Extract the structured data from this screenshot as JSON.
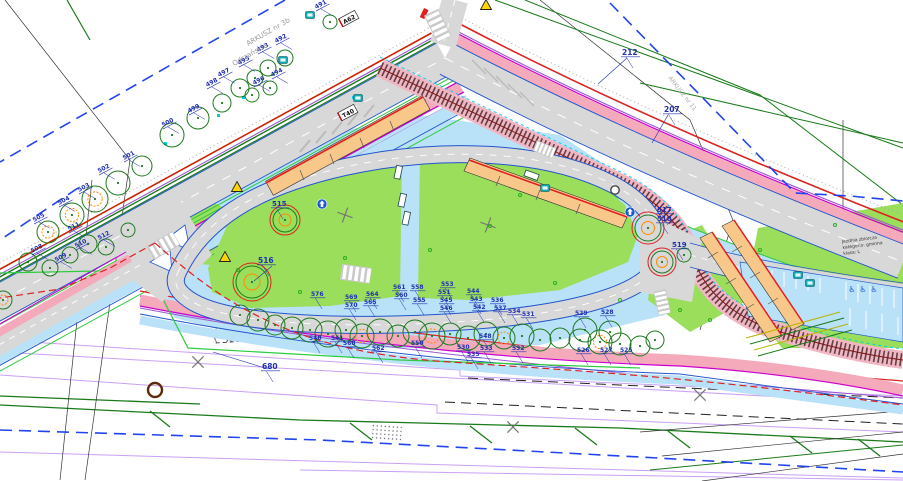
{
  "plan": {
    "title": "tram-bus loop site plan (CAD sheet fragment)",
    "palette": {
      "grass": "#9ade5b",
      "pavement": "#b9e2f8",
      "road": "#d8d8d8",
      "cycle_pink": "#f4aabb",
      "magenta": "#cc00cc",
      "purple": "#9b59d0",
      "lot_purple": "#c9a0f5",
      "red": "#dd2222",
      "dark_green": "#1a7a1a",
      "bright_green": "#2ecc40",
      "blue": "#2255cc",
      "boundary_blue": "#2244ee",
      "cyan": "#00ccee",
      "platform": "#f8c88a",
      "platform_edge": "#e02020",
      "tram_pink": "#f0b6c4",
      "label_blue": "#2030b0",
      "gray_text": "#999999",
      "tree_green": "#1f7a1f",
      "tree_orange": "#ff8c00",
      "tree_red": "#dd2222",
      "sign_yellow": "#ffd400",
      "sign_teal": "#12aab4",
      "sign_blue": "#1a56d6"
    },
    "texts_static": {
      "arkusz": "ARKUSZ nr 3b",
      "odrzanskie": "Odrzańskie",
      "arkusz11": "ARKUSZ nr 11",
      "note1": "Jezdnia zbiorcza",
      "note2": "kategoria: gminna",
      "note3": "klasa: L"
    },
    "plates": [
      {
        "t": "A62",
        "x": 349,
        "y": 19,
        "rot": -28
      },
      {
        "t": "T40",
        "x": 348,
        "y": 113,
        "rot": -28
      }
    ],
    "labels": [
      {
        "t": "491",
        "x": 316,
        "y": 9,
        "rot": -28
      },
      {
        "t": "492",
        "x": 276,
        "y": 43,
        "rot": -28
      },
      {
        "t": "493",
        "x": 258,
        "y": 52,
        "rot": -28
      },
      {
        "t": "494",
        "x": 272,
        "y": 77,
        "rot": -28
      },
      {
        "t": "495",
        "x": 239,
        "y": 65,
        "rot": -28
      },
      {
        "t": "496",
        "x": 254,
        "y": 85,
        "rot": -28
      },
      {
        "t": "497",
        "x": 219,
        "y": 77,
        "rot": -28
      },
      {
        "t": "498",
        "x": 207,
        "y": 87,
        "rot": -28
      },
      {
        "t": "499",
        "x": 189,
        "y": 113,
        "rot": -28
      },
      {
        "t": "500",
        "x": 163,
        "y": 127,
        "rot": -28
      },
      {
        "t": "501",
        "x": 124,
        "y": 160,
        "rot": -28
      },
      {
        "t": "502",
        "x": 99,
        "y": 173,
        "rot": -28
      },
      {
        "t": "503",
        "x": 79,
        "y": 192,
        "rot": -28
      },
      {
        "t": "504",
        "x": 59,
        "y": 205,
        "rot": -28
      },
      {
        "t": "505",
        "x": 34,
        "y": 222,
        "rot": -28
      },
      {
        "t": "508",
        "x": 32,
        "y": 253,
        "rot": -28
      },
      {
        "t": "509",
        "x": 56,
        "y": 262,
        "rot": -28
      },
      {
        "t": "510",
        "x": 76,
        "y": 248,
        "rot": -28
      },
      {
        "t": "511",
        "x": 69,
        "y": 231,
        "rot": -28
      },
      {
        "t": "512",
        "x": 99,
        "y": 240,
        "rot": -28
      },
      {
        "t": "515",
        "x": 272,
        "y": 206,
        "rot": 0,
        "s": 7
      },
      {
        "t": "516",
        "x": 258,
        "y": 263,
        "rot": 0,
        "s": 7.5
      },
      {
        "t": "517",
        "x": 657,
        "y": 212,
        "rot": 0,
        "s": 7
      },
      {
        "t": "518",
        "x": 657,
        "y": 221,
        "rot": 0,
        "s": 7
      },
      {
        "t": "519",
        "x": 672,
        "y": 247,
        "rot": 0,
        "s": 7
      },
      {
        "t": "212",
        "x": 622,
        "y": 55,
        "rot": 0,
        "s": 7.5
      },
      {
        "t": "207",
        "x": 664,
        "y": 112,
        "rot": 0,
        "s": 7.5
      },
      {
        "t": "680",
        "x": 262,
        "y": 369,
        "rot": 0,
        "s": 7.5
      },
      {
        "t": "576",
        "x": 311,
        "y": 296,
        "rot": 0
      },
      {
        "t": "569",
        "x": 345,
        "y": 299,
        "rot": 0
      },
      {
        "t": "570",
        "x": 345,
        "y": 307,
        "rot": 0
      },
      {
        "t": "568",
        "x": 343,
        "y": 345,
        "rot": 0
      },
      {
        "t": "564",
        "x": 366,
        "y": 296,
        "rot": 0
      },
      {
        "t": "565",
        "x": 364,
        "y": 304,
        "rot": 0
      },
      {
        "t": "561",
        "x": 393,
        "y": 289,
        "rot": 0
      },
      {
        "t": "560",
        "x": 395,
        "y": 297,
        "rot": 0
      },
      {
        "t": "558",
        "x": 411,
        "y": 289,
        "rot": 0
      },
      {
        "t": "555",
        "x": 413,
        "y": 302,
        "rot": 0
      },
      {
        "t": "553",
        "x": 441,
        "y": 286,
        "rot": 0
      },
      {
        "t": "551",
        "x": 438,
        "y": 294,
        "rot": 0
      },
      {
        "t": "545",
        "x": 440,
        "y": 302,
        "rot": 0
      },
      {
        "t": "546",
        "x": 440,
        "y": 310,
        "rot": 0
      },
      {
        "t": "544",
        "x": 467,
        "y": 293,
        "rot": 0
      },
      {
        "t": "543",
        "x": 470,
        "y": 301,
        "rot": 0
      },
      {
        "t": "542",
        "x": 473,
        "y": 309,
        "rot": 0
      },
      {
        "t": "536",
        "x": 491,
        "y": 302,
        "rot": 0
      },
      {
        "t": "537",
        "x": 494,
        "y": 310,
        "rot": 0
      },
      {
        "t": "534",
        "x": 508,
        "y": 313,
        "rot": 0
      },
      {
        "t": "531",
        "x": 522,
        "y": 316,
        "rot": 0
      },
      {
        "t": "562",
        "x": 372,
        "y": 350,
        "rot": 0
      },
      {
        "t": "550",
        "x": 411,
        "y": 345,
        "rot": 0
      },
      {
        "t": "548",
        "x": 479,
        "y": 338,
        "rot": 0
      },
      {
        "t": "541",
        "x": 331,
        "y": 340,
        "rot": 0
      },
      {
        "t": "540",
        "x": 309,
        "y": 340,
        "rot": 0
      },
      {
        "t": "530",
        "x": 457,
        "y": 349,
        "rot": 0
      },
      {
        "t": "535",
        "x": 467,
        "y": 356,
        "rot": 0
      },
      {
        "t": "533",
        "x": 480,
        "y": 350,
        "rot": 0
      },
      {
        "t": "532",
        "x": 512,
        "y": 350,
        "rot": 0
      },
      {
        "t": "529",
        "x": 575,
        "y": 315,
        "rot": 0
      },
      {
        "t": "528",
        "x": 601,
        "y": 314,
        "rot": 0
      },
      {
        "t": "526",
        "x": 577,
        "y": 352,
        "rot": 0
      },
      {
        "t": "527",
        "x": 600,
        "y": 352,
        "rot": 0
      },
      {
        "t": "525",
        "x": 620,
        "y": 352,
        "rot": 0
      }
    ],
    "leaders": [
      [
        627,
        58,
        598,
        84
      ],
      [
        668,
        115,
        652,
        143
      ],
      [
        268,
        369,
        213,
        352
      ],
      [
        272,
        266,
        254,
        281
      ]
    ],
    "trees": [
      [
        48,
        232,
        11,
        "go"
      ],
      [
        72,
        215,
        12,
        "go"
      ],
      [
        95,
        199,
        13,
        "go"
      ],
      [
        118,
        183,
        12,
        "g"
      ],
      [
        142,
        166,
        10,
        "g"
      ],
      [
        172,
        135,
        12,
        "g"
      ],
      [
        198,
        118,
        11,
        "g"
      ],
      [
        222,
        103,
        9,
        "g"
      ],
      [
        240,
        88,
        9,
        "g"
      ],
      [
        255,
        78,
        8,
        "g"
      ],
      [
        268,
        68,
        8,
        "g"
      ],
      [
        285,
        58,
        8,
        "g"
      ],
      [
        252,
        95,
        7,
        "g"
      ],
      [
        270,
        88,
        7,
        "g"
      ],
      [
        330,
        22,
        7,
        "g"
      ],
      [
        28,
        262,
        9,
        "g"
      ],
      [
        50,
        268,
        8,
        "g"
      ],
      [
        70,
        255,
        8,
        "g"
      ],
      [
        88,
        244,
        9,
        "g"
      ],
      [
        106,
        247,
        8,
        "g"
      ],
      [
        128,
        230,
        7,
        "g"
      ],
      [
        285,
        220,
        12,
        "gr"
      ],
      [
        252,
        282,
        16,
        "gr"
      ],
      [
        648,
        228,
        13,
        "gr"
      ],
      [
        662,
        262,
        11,
        "gr"
      ],
      [
        684,
        255,
        7,
        "g"
      ],
      [
        3,
        300,
        9,
        "go"
      ],
      [
        240,
        315,
        10,
        "g"
      ],
      [
        258,
        320,
        11,
        "g"
      ],
      [
        275,
        325,
        10,
        "g"
      ],
      [
        292,
        328,
        11,
        "g"
      ],
      [
        310,
        330,
        12,
        "g"
      ],
      [
        328,
        334,
        13,
        "g"
      ],
      [
        346,
        330,
        11,
        "g"
      ],
      [
        362,
        336,
        12,
        "go"
      ],
      [
        380,
        332,
        13,
        "g"
      ],
      [
        398,
        336,
        11,
        "g"
      ],
      [
        415,
        332,
        12,
        "g"
      ],
      [
        432,
        336,
        13,
        "go"
      ],
      [
        450,
        334,
        11,
        "g"
      ],
      [
        468,
        338,
        12,
        "g"
      ],
      [
        486,
        334,
        12,
        "g"
      ],
      [
        504,
        338,
        11,
        "go"
      ],
      [
        522,
        336,
        12,
        "g"
      ],
      [
        540,
        340,
        11,
        "g"
      ],
      [
        560,
        338,
        10,
        "g"
      ],
      [
        580,
        340,
        11,
        "g"
      ],
      [
        600,
        342,
        12,
        "go"
      ],
      [
        620,
        344,
        11,
        "g"
      ],
      [
        640,
        346,
        10,
        "g"
      ],
      [
        655,
        340,
        9,
        "g"
      ],
      [
        585,
        330,
        12,
        "g"
      ],
      [
        610,
        332,
        11,
        "g"
      ]
    ],
    "dots": [
      [
        345,
        258
      ],
      [
        490,
        226
      ],
      [
        555,
        283
      ],
      [
        300,
        292
      ],
      [
        620,
        300
      ],
      [
        680,
        310
      ],
      [
        520,
        195
      ],
      [
        430,
        250
      ],
      [
        238,
        270
      ],
      [
        710,
        320
      ],
      [
        760,
        250
      ],
      [
        835,
        225
      ]
    ],
    "marks": [
      {
        "x": 198,
        "y": 362,
        "rot": 45
      },
      {
        "x": 513,
        "y": 427,
        "rot": 45
      },
      {
        "x": 488,
        "y": 225,
        "rot": 20
      },
      {
        "x": 700,
        "y": 395,
        "rot": 45
      },
      {
        "x": 345,
        "y": 215,
        "rot": 20
      }
    ],
    "signs": {
      "yellow_triangles": [
        [
          237,
          187
        ],
        [
          225,
          257
        ],
        [
          486,
          5
        ]
      ],
      "teal_boxes": [
        [
          310,
          15
        ],
        [
          283,
          60
        ],
        [
          358,
          98
        ],
        [
          798,
          275
        ],
        [
          810,
          283
        ],
        [
          545,
          188
        ]
      ],
      "blue_circles": [
        [
          630,
          212
        ],
        [
          322,
          204
        ]
      ],
      "white_circles": [
        [
          615,
          190
        ]
      ],
      "wheelchair_glyph": "♿",
      "wheelchairs": [
        [
          852,
          292
        ],
        [
          863,
          292
        ],
        [
          874,
          292
        ]
      ]
    }
  }
}
